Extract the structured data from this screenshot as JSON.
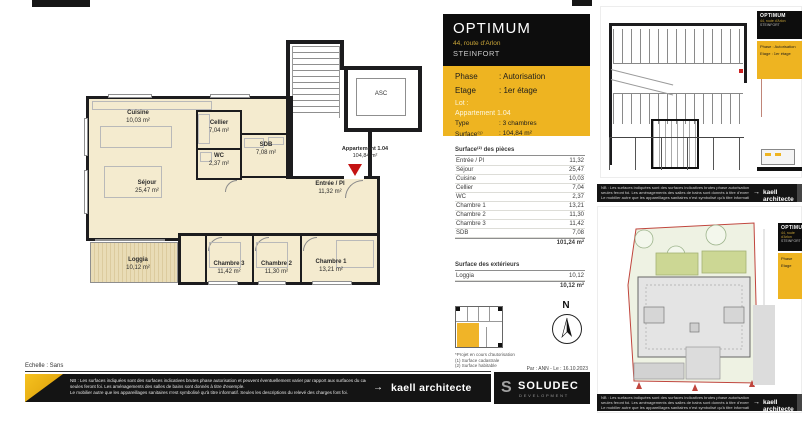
{
  "page": {
    "scale_label": "Echelle : Sans",
    "byline": "Par : ANN - Le : 16.10.2023"
  },
  "title_block": {
    "project": "OPTIMUM",
    "address": "44, route d'Arlon",
    "city": "STEINFORT",
    "phase_label": "Phase",
    "phase_value": ": Autorisation",
    "etage_label": "Etage",
    "etage_value": ": 1er étage",
    "lot_label": "Lot :",
    "lot_value": "Appartement 1.04",
    "type_label": "Type",
    "type_value": ": 3 chambres",
    "surface_label": "Surface⁽¹⁾",
    "surface_value": ": 104,84 m²"
  },
  "rooms_table": {
    "title": "Surface⁽²⁾ des pièces",
    "rows": [
      [
        "Entrée / Pl",
        "11,32"
      ],
      [
        "Séjour",
        "25,47"
      ],
      [
        "Cuisine",
        "10,03"
      ],
      [
        "Cellier",
        "7,04"
      ],
      [
        "WC",
        "2,37"
      ],
      [
        "Chambre 1",
        "13,21"
      ],
      [
        "Chambre 2",
        "11,30"
      ],
      [
        "Chambre 3",
        "11,42"
      ],
      [
        "SDB",
        "7,08"
      ]
    ],
    "total": "101,24 m²"
  },
  "ext_table": {
    "title": "Surface des extérieurs",
    "rows": [
      [
        "Loggia",
        "10,12"
      ]
    ],
    "total": "10,12 m²"
  },
  "notes": [
    "*Projet en cours d'autorisation",
    "(1) Surface cadastrale",
    "(2) Surface habitable"
  ],
  "plan": {
    "rooms": [
      {
        "name": "Cuisine",
        "area": "10,03 m²"
      },
      {
        "name": "Séjour",
        "area": "25,47 m²"
      },
      {
        "name": "Cellier",
        "area": "7,04 m²"
      },
      {
        "name": "WC",
        "area": "2,37 m²"
      },
      {
        "name": "SDB",
        "area": "7,08 m²"
      },
      {
        "name": "Entrée / Pl",
        "area": "11,32 m²"
      },
      {
        "name": "Chambre 3",
        "area": "11,42 m²"
      },
      {
        "name": "Chambre 2",
        "area": "11,30 m²"
      },
      {
        "name": "Chambre 1",
        "area": "13,21 m²"
      },
      {
        "name": "Loggia",
        "area": "10,12 m²"
      }
    ],
    "apartment": {
      "label": "Appartement 1.04",
      "area": "104,84 m²"
    },
    "elevator": "ASC",
    "compass": "N"
  },
  "footer": {
    "nb_lines": [
      "NB : Les surfaces indiquées sont des surfaces indicatives brutes phase autorisation et peuvent éventuellement varier par rapport aux surfaces du cadastre vertical qui",
      "seules feront foi. Les aménagements des salles de bains sont donnés à titre d'exemple.",
      "Le mobilier autre que les appareillages sanitaires n'est symbolisé qu'à titre informatif. Seules les descriptions du relevé des charges font foi."
    ],
    "arrow": "→",
    "architect": "kaell architecte",
    "brand_initial": "S",
    "brand": "SOLUDEC",
    "brand_sub": "DEVELOPMENT"
  },
  "colors": {
    "brand_yellow": "#EEB421",
    "ink": "#141414",
    "entrance_red": "#C41212",
    "boundary_red": "#C0453D",
    "room_fill": "#F4EBCF"
  }
}
